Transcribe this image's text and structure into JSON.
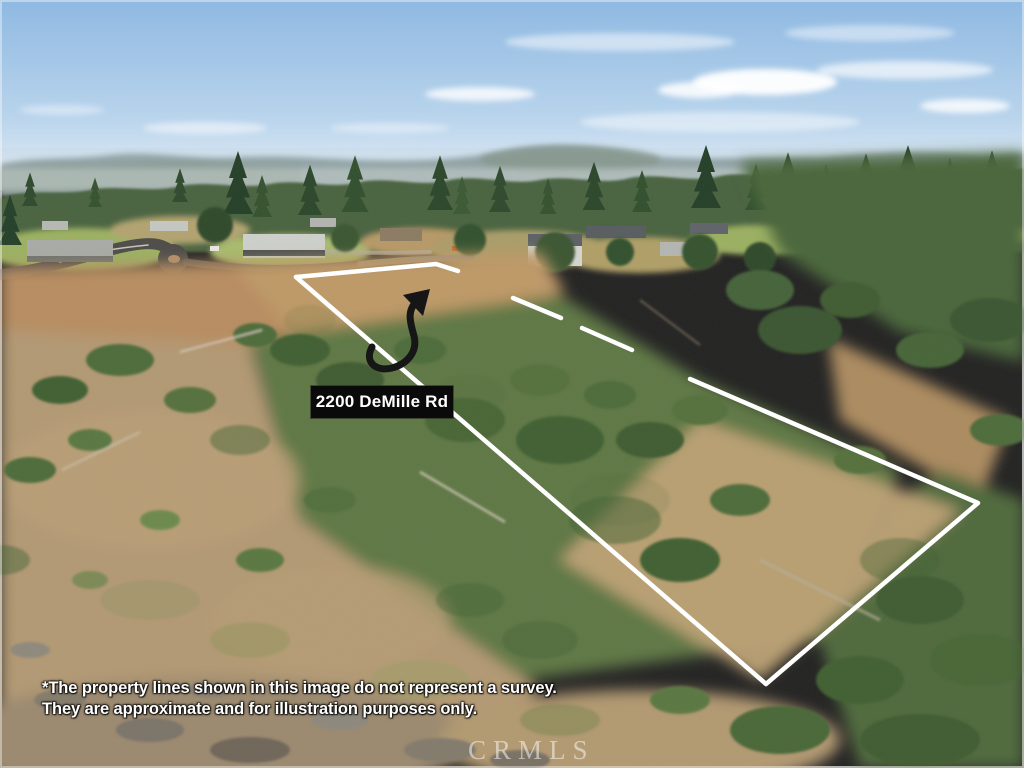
{
  "annotations": {
    "address_label": "2200 DeMille Rd",
    "disclaimer": {
      "line1": "*The property lines shown in this image do not represent a survey.",
      "line2": "They are approximate and for illustration purposes only."
    },
    "watermark": "CRMLS"
  },
  "colors": {
    "boundary_line": "#ffffff",
    "arrow": "#161616",
    "label_background": "#0a0a0a",
    "label_text": "#ffffff",
    "disclaimer_text": "#ffffff",
    "watermark_text": "rgba(255,255,255,0.5)",
    "sky_top": "#8fb9e2",
    "sky_horizon": "#e9f0f6",
    "ridge_haze": "#93a5a8",
    "conifer_green": "#3c5733",
    "scrub_green": "#5f7845",
    "dry_grass": "#b59a74",
    "dirt_tan": "#c09a68",
    "asphalt": "#4e4c49"
  }
}
